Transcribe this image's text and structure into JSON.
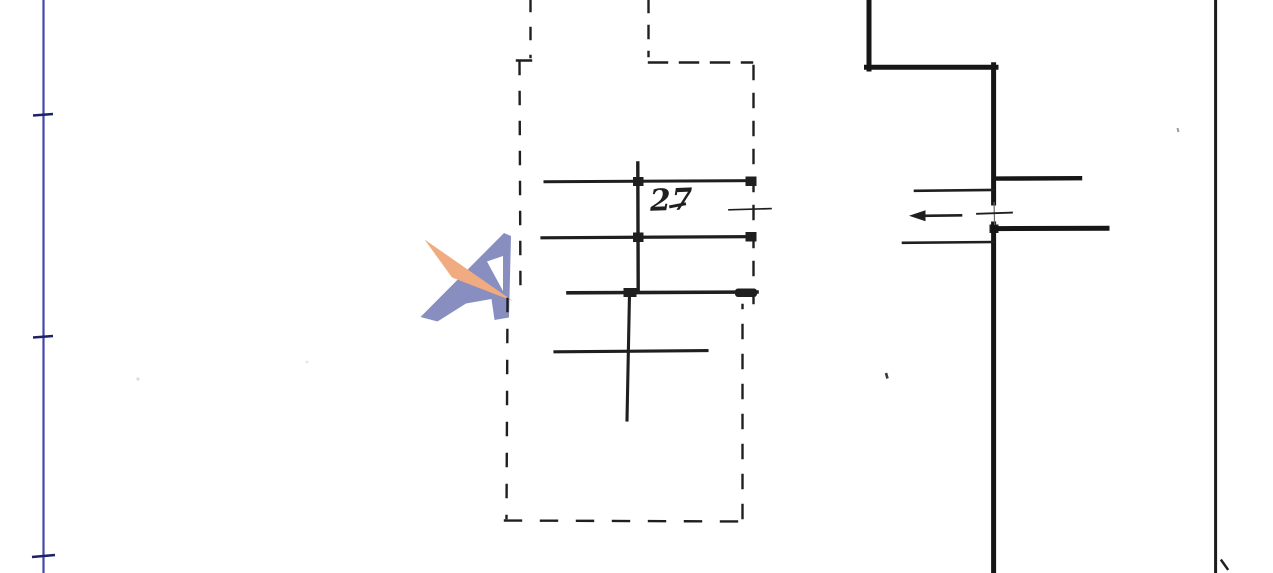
{
  "sheet": {
    "room_label": "27",
    "colors": {
      "paper": "#ffffff",
      "ink": "#1f1f1f",
      "wall": "#161616",
      "border": "#1c1c1c",
      "ruler_line": "#4348a8",
      "ruler_tick": "#1d2268",
      "watermark_blue": "#828abd",
      "watermark_orange": "#f0a87a"
    }
  }
}
